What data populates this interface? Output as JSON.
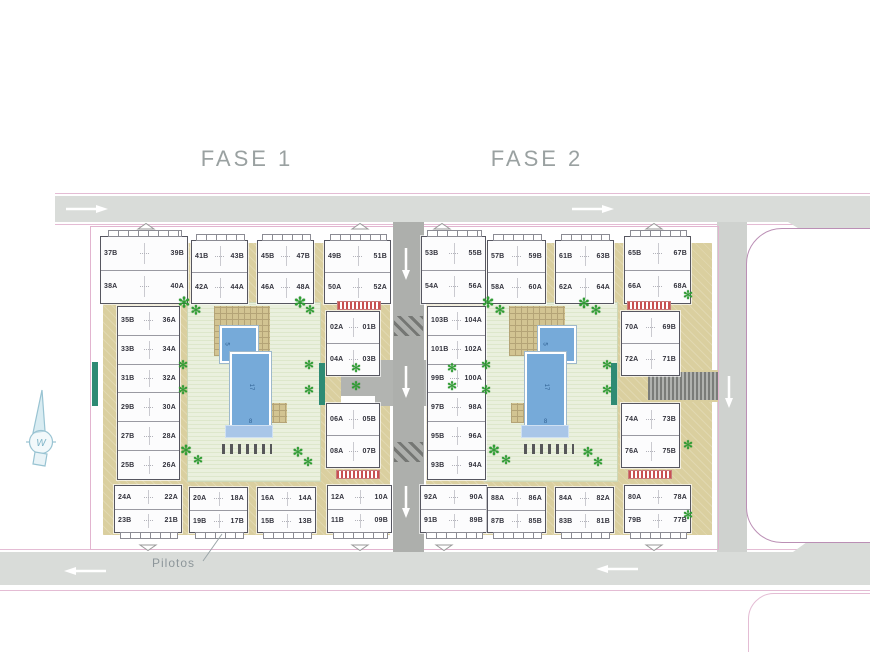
{
  "titles": {
    "fase1": "FASE 1",
    "fase2": "FASE 2"
  },
  "annotations": {
    "pilotos": "Pilotos",
    "compass_letter": "W"
  },
  "courtyard": {
    "pool_small_label": "5",
    "pool_length_label": "17",
    "pool_width_label": "8"
  },
  "colors": {
    "road": "#d9dcd9",
    "central_road": "#adafac",
    "sand_terrace": "#dacf9f",
    "lawn": "#eaf0de",
    "pool_blue": "#76aad9",
    "boundary_pink": "#e2b4cf",
    "island_outline": "#bb8fb5",
    "palm_green": "#2f9e33",
    "stripe_red": "#c85050",
    "gate_teal": "#2e8b74",
    "title_gray": "#9aa1a1"
  },
  "phases": [
    {
      "label": "FASE 1"
    },
    {
      "label": "FASE 2"
    }
  ],
  "buildings": {
    "f1t1": [
      [
        "37B",
        "39B"
      ],
      [
        "38A",
        "40A"
      ]
    ],
    "f1t2": [
      [
        "41B",
        "43B"
      ],
      [
        "42A",
        "44A"
      ]
    ],
    "f1t3": [
      [
        "45B",
        "47B"
      ],
      [
        "46A",
        "48A"
      ]
    ],
    "f1t4": [
      [
        "49B",
        "51B"
      ],
      [
        "50A",
        "52A"
      ]
    ],
    "f1w": [
      [
        "35B",
        "36A"
      ],
      [
        "33B",
        "34A"
      ],
      [
        "31B",
        "32A"
      ],
      [
        "29B",
        "30A"
      ],
      [
        "27B",
        "28A"
      ],
      [
        "25B",
        "26A"
      ]
    ],
    "f1e1": [
      [
        "02A",
        "01B"
      ],
      [
        "04A",
        "03B"
      ]
    ],
    "f1e2": [
      [
        "06A",
        "05B"
      ],
      [
        "08A",
        "07B"
      ]
    ],
    "f1b1": [
      [
        "24A",
        "22A"
      ],
      [
        "23B",
        "21B"
      ]
    ],
    "f1b2": [
      [
        "20A",
        "18A"
      ],
      [
        "19B",
        "17B"
      ]
    ],
    "f1b3": [
      [
        "16A",
        "14A"
      ],
      [
        "15B",
        "13B"
      ]
    ],
    "f1b4": [
      [
        "12A",
        "10A"
      ],
      [
        "11B",
        "09B"
      ]
    ],
    "f2t1": [
      [
        "53B",
        "55B"
      ],
      [
        "54A",
        "56A"
      ]
    ],
    "f2t2": [
      [
        "57B",
        "59B"
      ],
      [
        "58A",
        "60A"
      ]
    ],
    "f2t3": [
      [
        "61B",
        "63B"
      ],
      [
        "62A",
        "64A"
      ]
    ],
    "f2t4": [
      [
        "65B",
        "67B"
      ],
      [
        "66A",
        "68A"
      ]
    ],
    "f2w": [
      [
        "103B",
        "104A"
      ],
      [
        "101B",
        "102A"
      ],
      [
        "99B",
        "100A"
      ],
      [
        "97B",
        "98A"
      ],
      [
        "95B",
        "96A"
      ],
      [
        "93B",
        "94A"
      ]
    ],
    "f2e1": [
      [
        "70A",
        "69B"
      ],
      [
        "72A",
        "71B"
      ]
    ],
    "f2e2": [
      [
        "74A",
        "73B"
      ],
      [
        "76A",
        "75B"
      ]
    ],
    "f2b1": [
      [
        "92A",
        "90A"
      ],
      [
        "91B",
        "89B"
      ]
    ],
    "f2b2": [
      [
        "88A",
        "86A"
      ],
      [
        "87B",
        "85B"
      ]
    ],
    "f2b3": [
      [
        "84A",
        "82A"
      ],
      [
        "83B",
        "81B"
      ]
    ],
    "f2b4": [
      [
        "80A",
        "78A"
      ],
      [
        "79B",
        "77B"
      ]
    ]
  }
}
